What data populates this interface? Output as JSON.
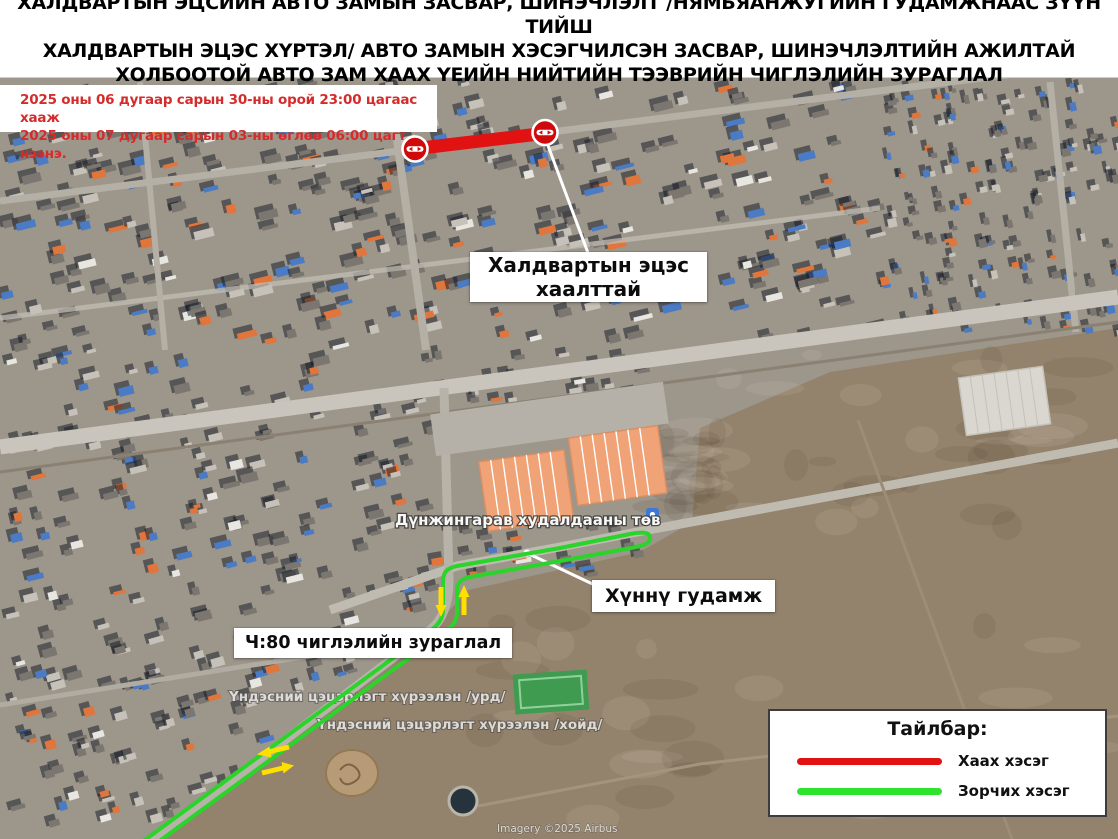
{
  "header": {
    "title_lines": [
      "ХАЛДВАРТЫН ЭЦСИЙН АВТО ЗАМЫН ЗАСВАР, ШИНЭЧЛЭЛТ /НЯМЬЯАНЖУГИЙН ГУДАМЖНААС ЗҮҮН ТИЙШ",
      "ХАЛДВАРТЫН ЭЦЭС ХҮРТЭЛ/  АВТО ЗАМЫН ХЭСЭГЧИЛСЭН ЗАСВАР, ШИНЭЧЛЭЛТИЙН АЖИЛТАЙ",
      "ХОЛБООТОЙ АВТО ЗАМ ХААХ ҮЕИЙН НИЙТИЙН ТЭЭВРИЙН ЧИГЛЭЛИЙН ЗУРАГЛАЛ"
    ]
  },
  "date_notice": {
    "lines": [
      "2025 оны 06 дугаар сарын 30-ны орой 23:00 цагаас хааж",
      "2025 оны 07 дугаар сарын 03-ны өглөө 06:00 цагт нээнэ."
    ],
    "text_color": "#d62b2b"
  },
  "callouts": {
    "closure": {
      "line1": "Халдвартын эцэс",
      "line2": "хаалттай"
    },
    "street": {
      "label": "Хүннү гудамж"
    },
    "route_map": {
      "label": "Ч:80 чиглэлийн зураглал"
    }
  },
  "map_labels": {
    "mall": "Дүнжингарав худалдааны төв",
    "park_south": "Үндэсний цэцэрлэгт хүрээлэн /урд/",
    "park_north": "Үндэсний цэцэрлэгт хүрээлэн /хойд/",
    "attribution": "Imagery ©2025 Airbus"
  },
  "legend": {
    "title": "Тайлбар:",
    "items": [
      {
        "label": "Хаах хэсэг",
        "color": "#e01212"
      },
      {
        "label": "Зорчих хэсэг",
        "color": "#2ee32e"
      }
    ]
  },
  "route_overlay": {
    "closed_color": "#e01212",
    "detour_color": "#2ad42a",
    "arrow_color": "#ffdf00",
    "no_entry_icon": "no-entry-sign"
  }
}
